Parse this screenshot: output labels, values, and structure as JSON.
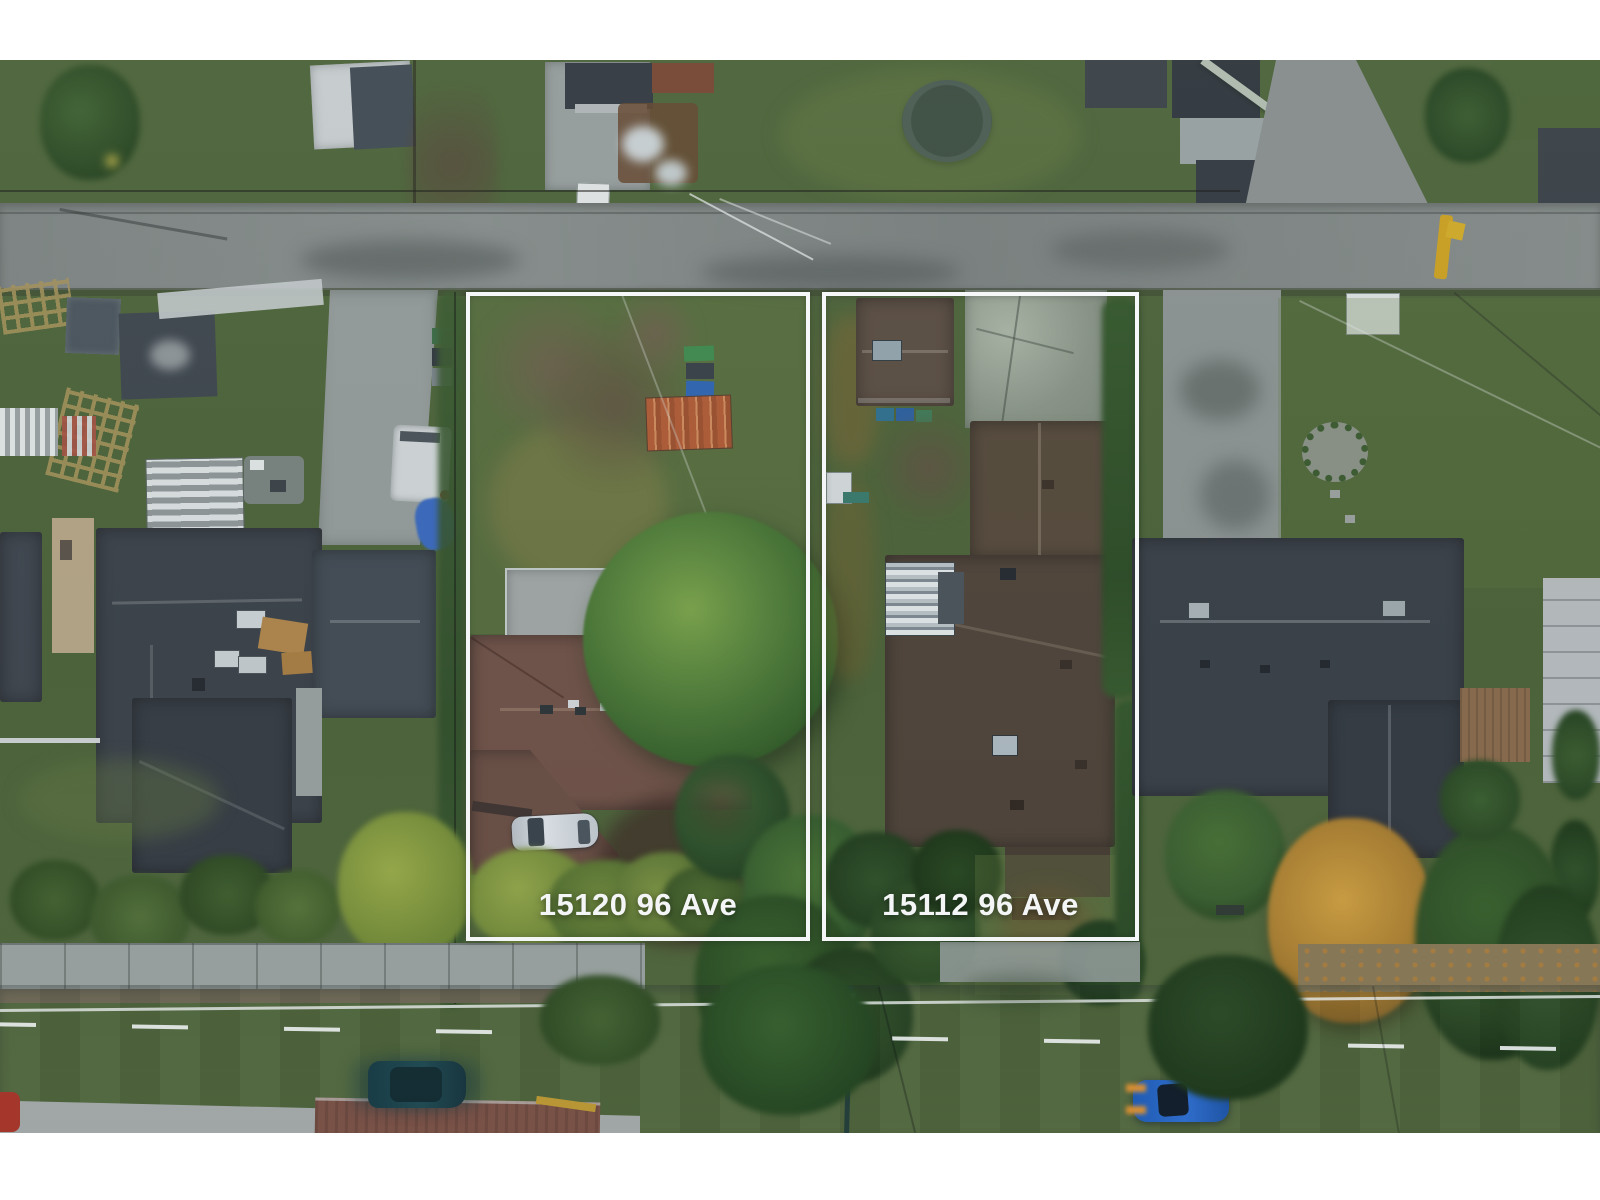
{
  "overlay": {
    "lots": [
      {
        "label": "15120 96 Ave"
      },
      {
        "label": "15112 96 Ave"
      }
    ],
    "outline_color": "#ffffff",
    "label_color": "#ffffff"
  },
  "scene": {
    "description": "Aerial drone photo of two adjacent residential lots outlined in white, between a rear laneway at top and 96 Avenue at bottom",
    "palette": {
      "grass": "#4d6238",
      "lane_asphalt": "#828886",
      "street_asphalt": "#818d8b",
      "left_house_roof": "#6f5146",
      "right_house_roof": "#4e4237",
      "neighbor_roof_dark": "#383e45",
      "big_tree_green": "#55823a",
      "autumn_tree_gold": "#b8903a",
      "rust_shed": "#b05a33",
      "blue_tarp": "#3968bd",
      "silver_car": "#c8cdd1",
      "teal_suv": "#1f4a52",
      "blue_car": "#2e6fd2",
      "yellow_pole": "#cfa21f",
      "white_margin": "#ffffff"
    }
  }
}
